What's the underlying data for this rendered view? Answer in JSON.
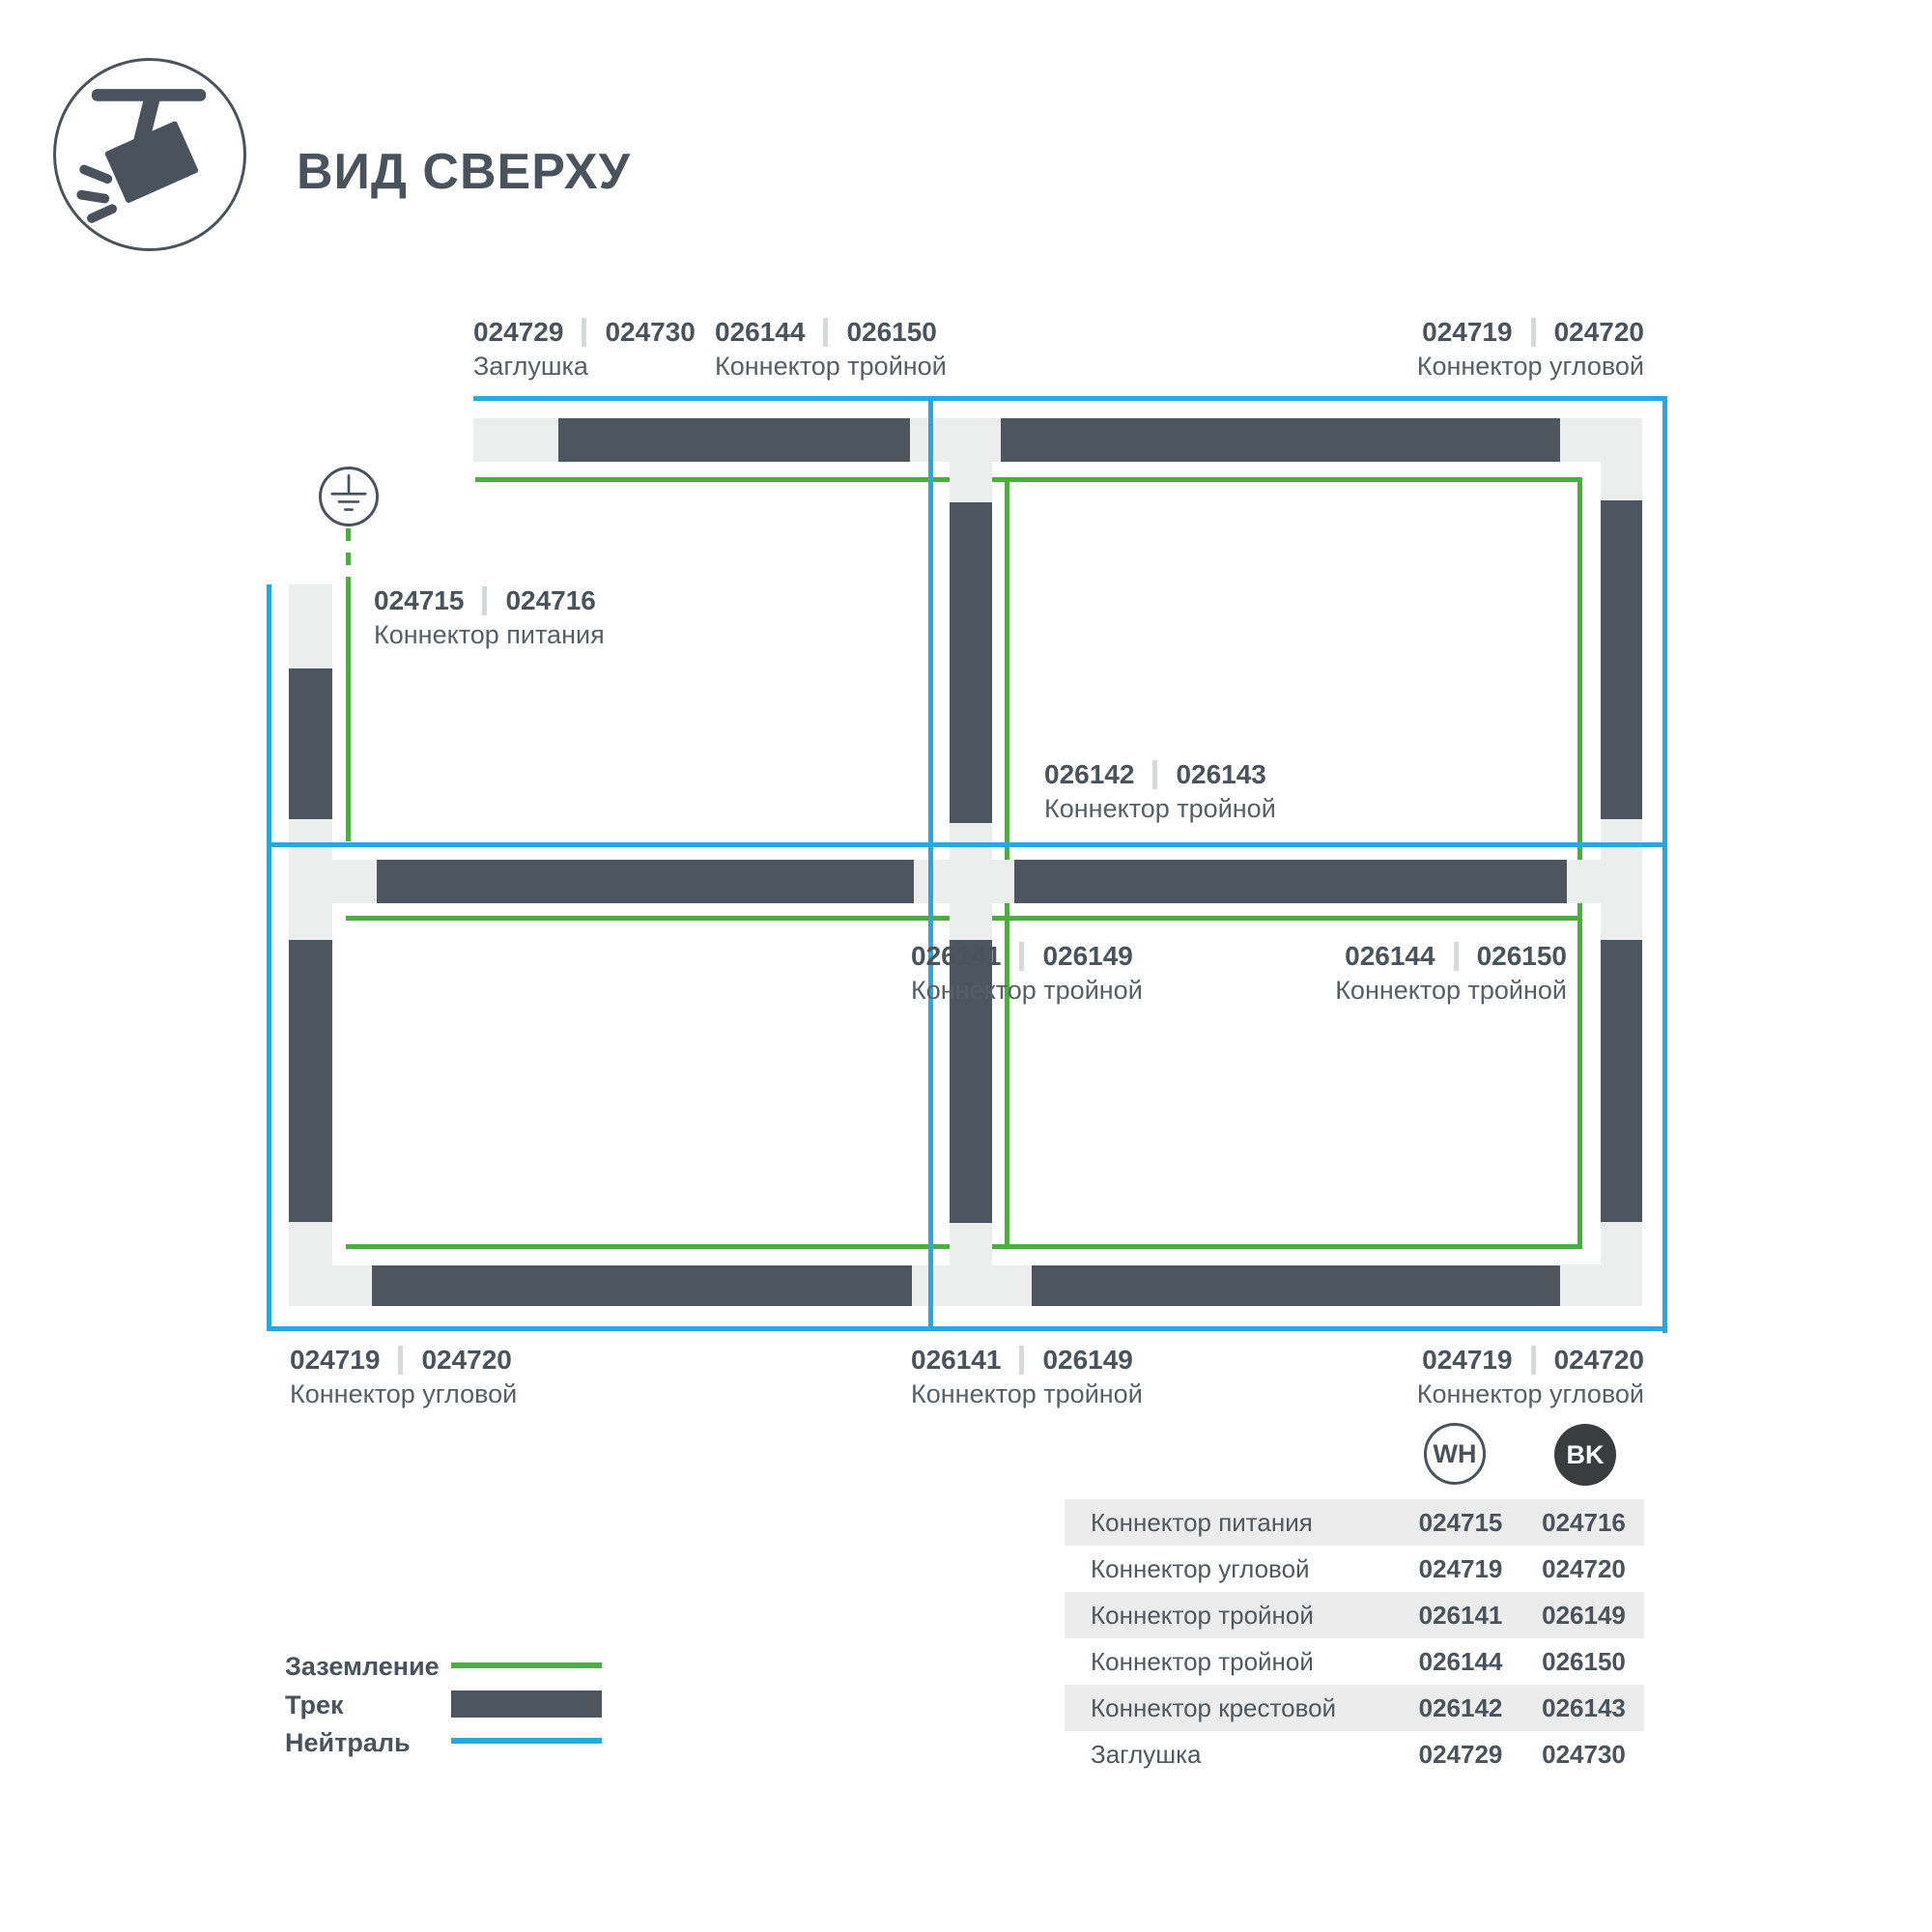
{
  "header": {
    "title": "ВИД СВЕРХУ",
    "icon": "track-spotlight-icon"
  },
  "colors": {
    "track": "#4d565e",
    "connector": "#eceeed",
    "ground_green": "#4bae3f",
    "neutral_blue": "#29a8e0",
    "text": "#4a535b",
    "table_band": "#ececec",
    "badge_bk_fill": "#3b3c3d"
  },
  "diagram": {
    "labels": [
      {
        "id": "endcap-top",
        "wh": "024729",
        "bk": "024730",
        "name": "Заглушка"
      },
      {
        "id": "triple-top",
        "wh": "026144",
        "bk": "026150",
        "name": "Коннектор тройной"
      },
      {
        "id": "corner-top-right",
        "wh": "024719",
        "bk": "024720",
        "name": "Коннектор угловой"
      },
      {
        "id": "power-feed",
        "wh": "024715",
        "bk": "024716",
        "name": "Коннектор питания"
      },
      {
        "id": "cross-center",
        "wh": "026142",
        "bk": "026143",
        "name": "Коннектор тройной"
      },
      {
        "id": "triple-cell-left",
        "wh": "026141",
        "bk": "026149",
        "name": "Коннектор тройной"
      },
      {
        "id": "triple-cell-right",
        "wh": "026144",
        "bk": "026150",
        "name": "Коннектор тройной"
      },
      {
        "id": "corner-bottom-left",
        "wh": "024719",
        "bk": "024720",
        "name": "Коннектор угловой"
      },
      {
        "id": "triple-bottom",
        "wh": "026141",
        "bk": "026149",
        "name": "Коннектор тройной"
      },
      {
        "id": "corner-bottom-right",
        "wh": "024719",
        "bk": "024720",
        "name": "Коннектор угловой"
      }
    ]
  },
  "legend": {
    "items": [
      {
        "label": "Заземление",
        "swatch": "ground-line"
      },
      {
        "label": "Трек",
        "swatch": "track-bar"
      },
      {
        "label": "Нейтраль",
        "swatch": "neutral-line"
      }
    ]
  },
  "badges": {
    "wh": "WH",
    "bk": "BK"
  },
  "table": {
    "rows": [
      {
        "label": "Коннектор питания",
        "wh": "024715",
        "bk": "024716"
      },
      {
        "label": "Коннектор угловой",
        "wh": "024719",
        "bk": "024720"
      },
      {
        "label": "Коннектор тройной",
        "wh": "026141",
        "bk": "026149"
      },
      {
        "label": "Коннектор тройной",
        "wh": "026144",
        "bk": "026150"
      },
      {
        "label": "Коннектор крестовой",
        "wh": "026142",
        "bk": "026143"
      },
      {
        "label": "Заглушка",
        "wh": "024729",
        "bk": "024730"
      }
    ]
  }
}
